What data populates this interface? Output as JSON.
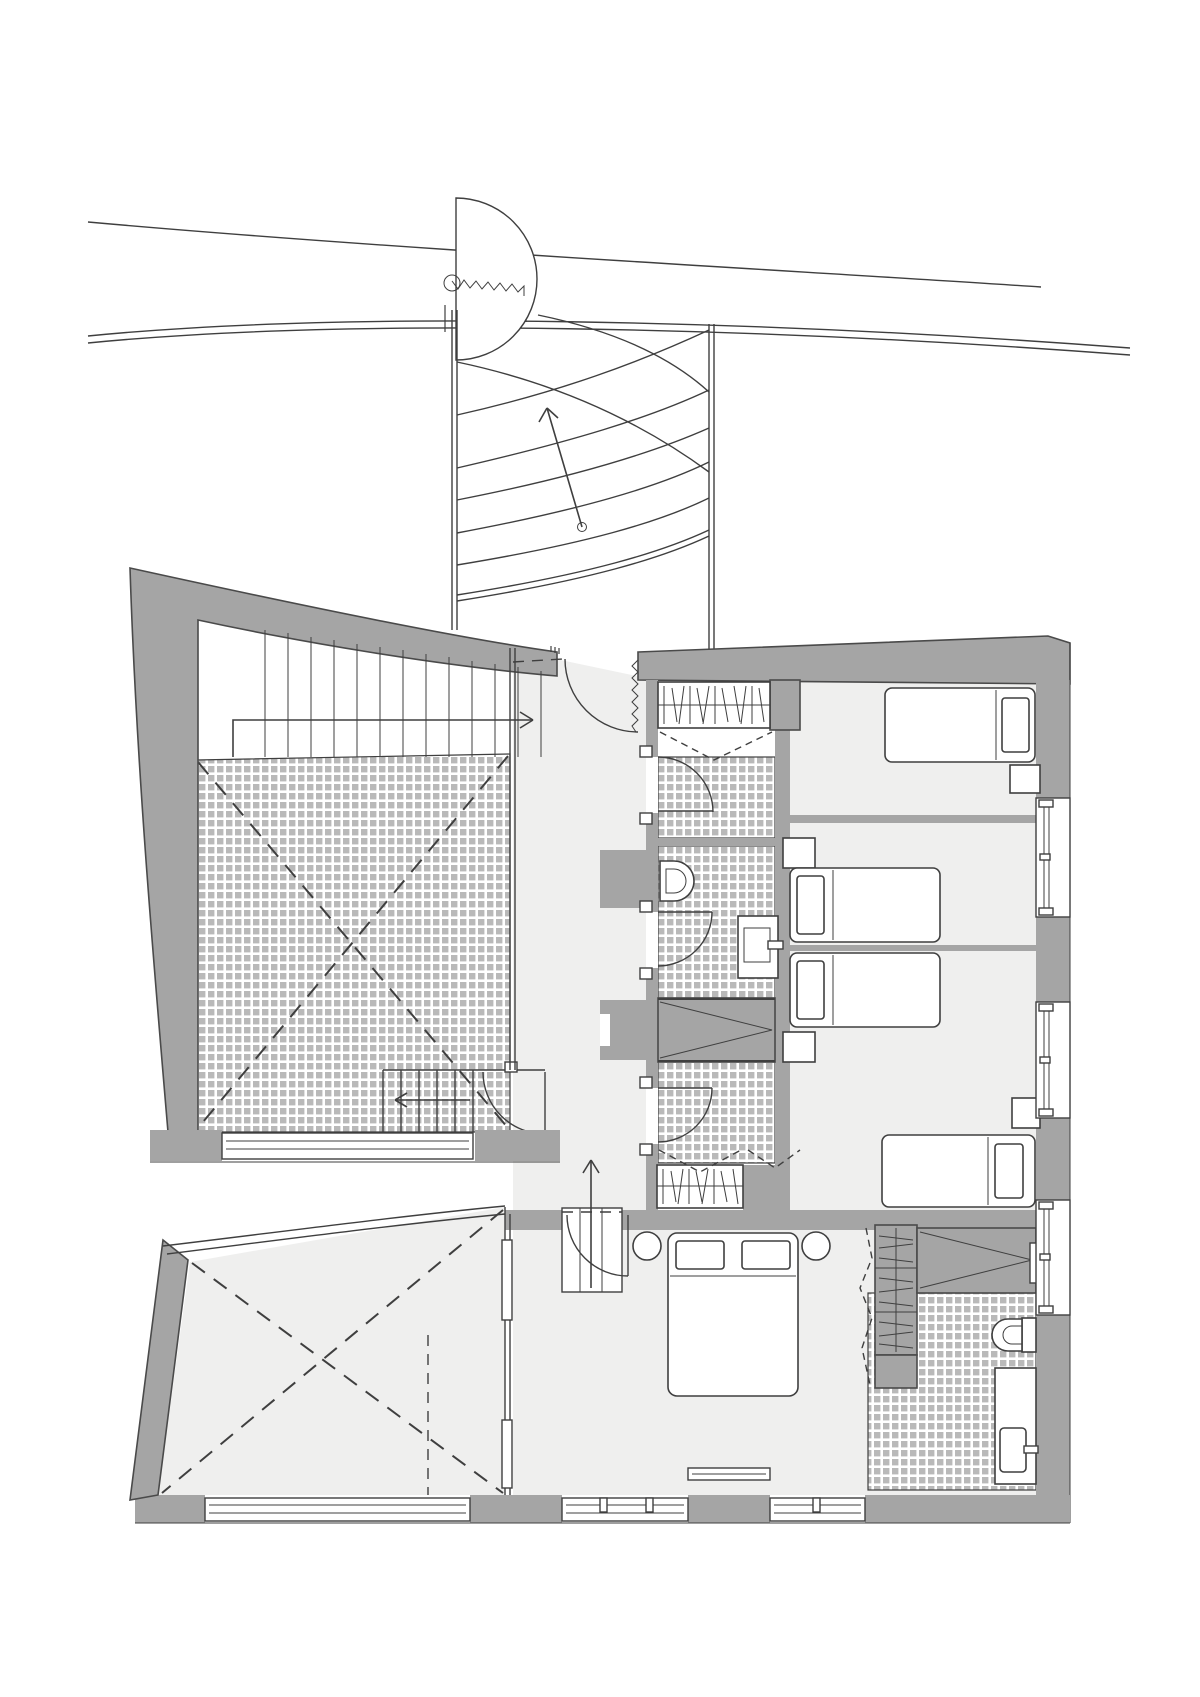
{
  "figure": {
    "kind": "architectural-floor-plan",
    "visible_text": []
  },
  "palette": {
    "paper": "#ffffff",
    "line": "#3f3f3f",
    "wall": "#a5a5a5",
    "wallstroke": "#4a4a4a",
    "floor": "#efefee",
    "tile": "#b9b9b9"
  },
  "elements": {
    "street": "street-edge-lines",
    "gate": "gate-door-swing",
    "exterior_stair": "curved-exterior-stair",
    "terrace": "tiled-terrace-with-dashed-cross",
    "interior_stair": "straight-stair-along-top-wall",
    "hall": "central-hall",
    "bathrooms": [
      "bathroom-top",
      "bathroom-middle",
      "bathroom-ensuite"
    ],
    "bedrooms": [
      "bedroom-top-right",
      "bedroom-middle-right",
      "bedroom-twin",
      "master-bedroom"
    ],
    "void": "double-height-void-dashed-cross"
  }
}
